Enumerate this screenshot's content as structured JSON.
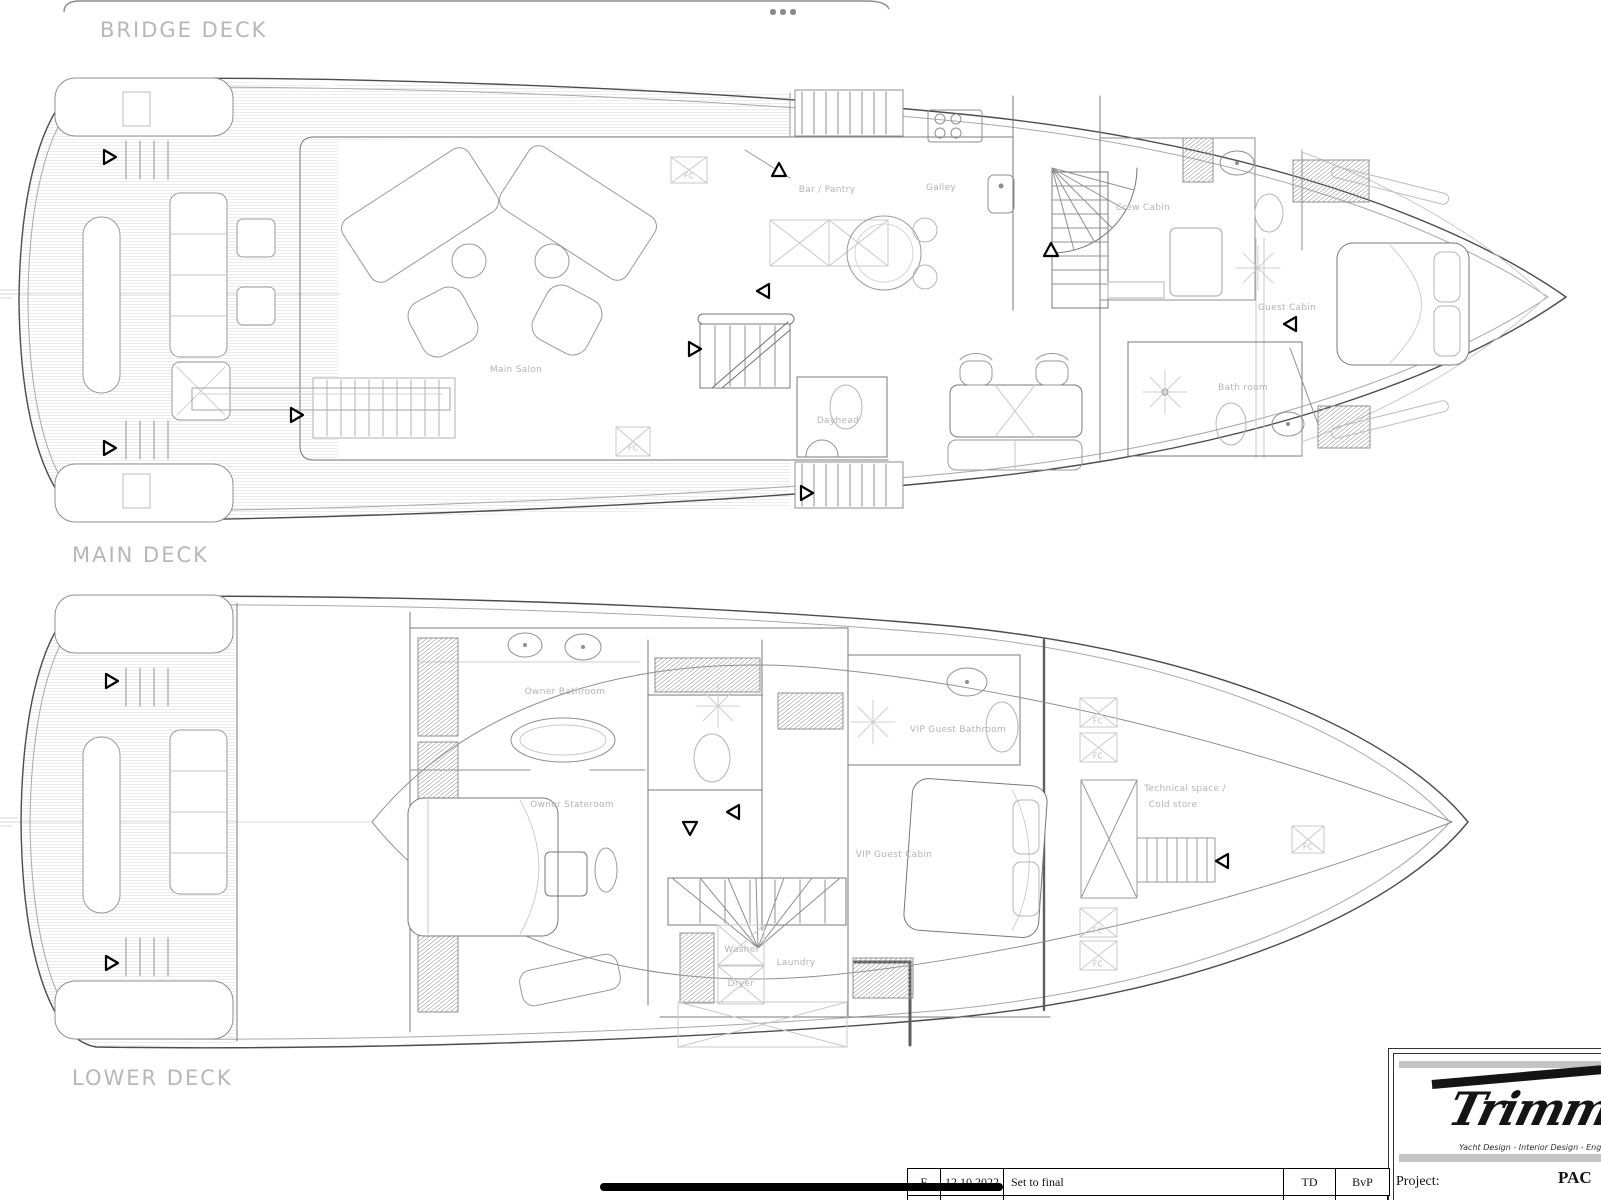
{
  "deck_labels": {
    "bridge": "BRIDGE DECK",
    "main": "MAIN DECK",
    "lower": "LOWER DECK"
  },
  "main_deck": {
    "rooms": {
      "bar_pantry": "Bar / Pantry",
      "galley": "Galley",
      "crew_cabin": "Crew Cabin",
      "guest_cabin": "Guest Cabin",
      "bathroom": "Bath room",
      "main_salon": "Main Salon",
      "dayhead": "Dayhead"
    }
  },
  "lower_deck": {
    "rooms": {
      "owner_bathroom": "Owner Bathroom",
      "owner_stateroom": "Owner Stateroom",
      "vip_guest_bathroom": "VIP Guest Bathroom",
      "vip_guest_cabin": "VIP Guest Cabin",
      "technical_space_line1": "Technical space /",
      "technical_space_line2": "Cold store",
      "washer": "Washer",
      "dryer": "Dryer",
      "laundry": "Laundry"
    }
  },
  "markers": {
    "floor_chase": "FC"
  },
  "title_block": {
    "logo": "Trimm",
    "tagline": "Yacht Design - Interior Design - Engineering",
    "project_label": "Project:",
    "project_name_partial": "PAC"
  },
  "revision_table": {
    "rows": [
      {
        "rev": "E",
        "date": "12.10.2022",
        "description": "Set to final",
        "drawn": "TD",
        "checked": "BvP"
      }
    ]
  },
  "colors": {
    "label_gray": "#b4b4b4",
    "hull_line": "#4c4c4c",
    "logo_black": "#141414"
  }
}
